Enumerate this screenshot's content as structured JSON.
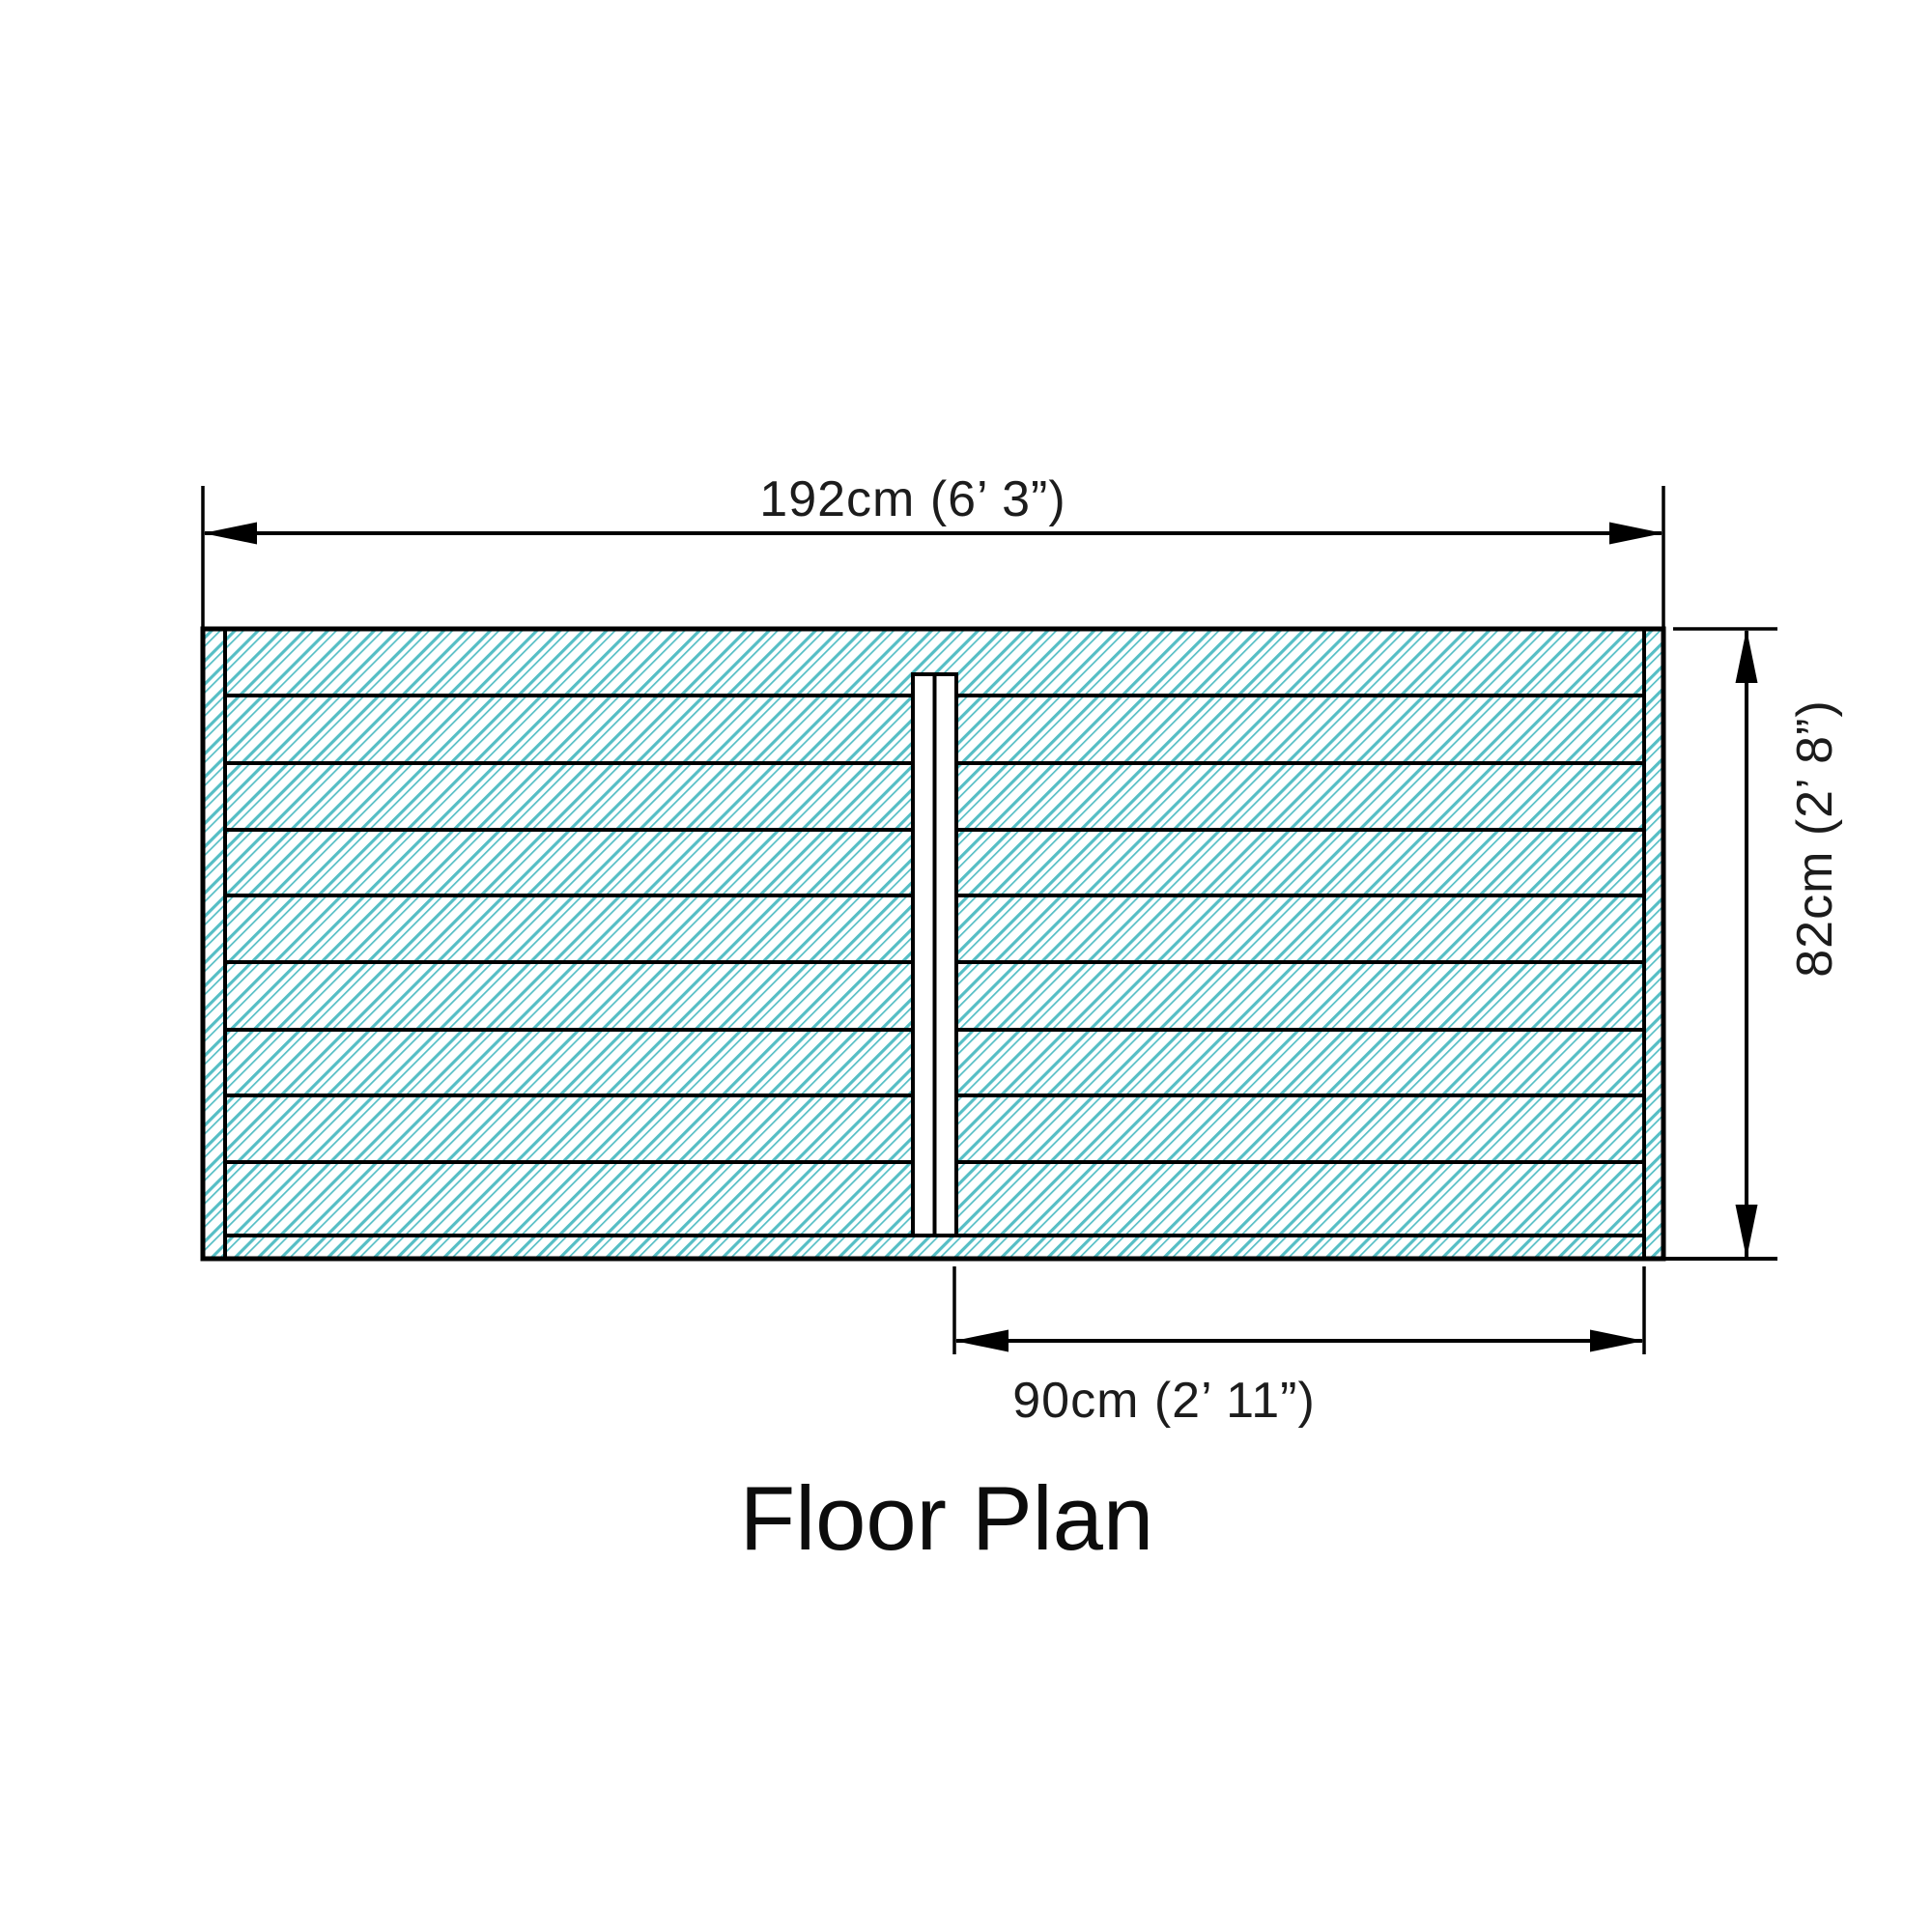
{
  "diagram": {
    "title": "Floor Plan",
    "dimensions": {
      "width_label": "192cm (6’ 3”)",
      "depth_label": "82cm (2’ 8”)",
      "door_label": "90cm (2’ 11”)"
    },
    "colors": {
      "hatch": "#55bec5",
      "line": "#000000"
    }
  }
}
